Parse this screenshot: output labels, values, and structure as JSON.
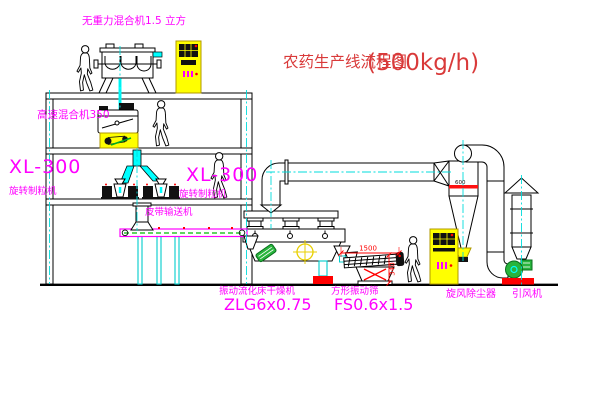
{
  "title": {
    "text": "农药生产线流程图",
    "capacity": "(500kg/h)"
  },
  "equipment_labels": {
    "gravity_mixer": "无重力混合机1.5 立方",
    "high_speed_mixer": "高速混合机350",
    "granulator_left_model": "XL-300",
    "granulator_left_name": "旋转制粒机",
    "granulator_right_model": "XL-300",
    "granulator_right_name": "旋转制粒机",
    "belt_conveyor": "皮带输送机",
    "dryer_name": "振动流化床干燥机",
    "dryer_model": "ZLG6x0.75",
    "screen_name": "方形振动筛",
    "screen_model": "FS0.6x1.5",
    "cyclone": "旋风除尘器",
    "fan": "引风机"
  },
  "dimensions": {
    "screen_length": "1500",
    "screen_height": "340",
    "cyclone_marking": "600"
  },
  "colors": {
    "label_magenta": "#ff00ff",
    "title_red": "#d93a3a",
    "dimension_red": "#ff0000",
    "pipe_cyan": "#00ffff",
    "cabinet_yellow": "#ffff00",
    "machine_green": "#28b43c",
    "line_black": "#000000"
  }
}
